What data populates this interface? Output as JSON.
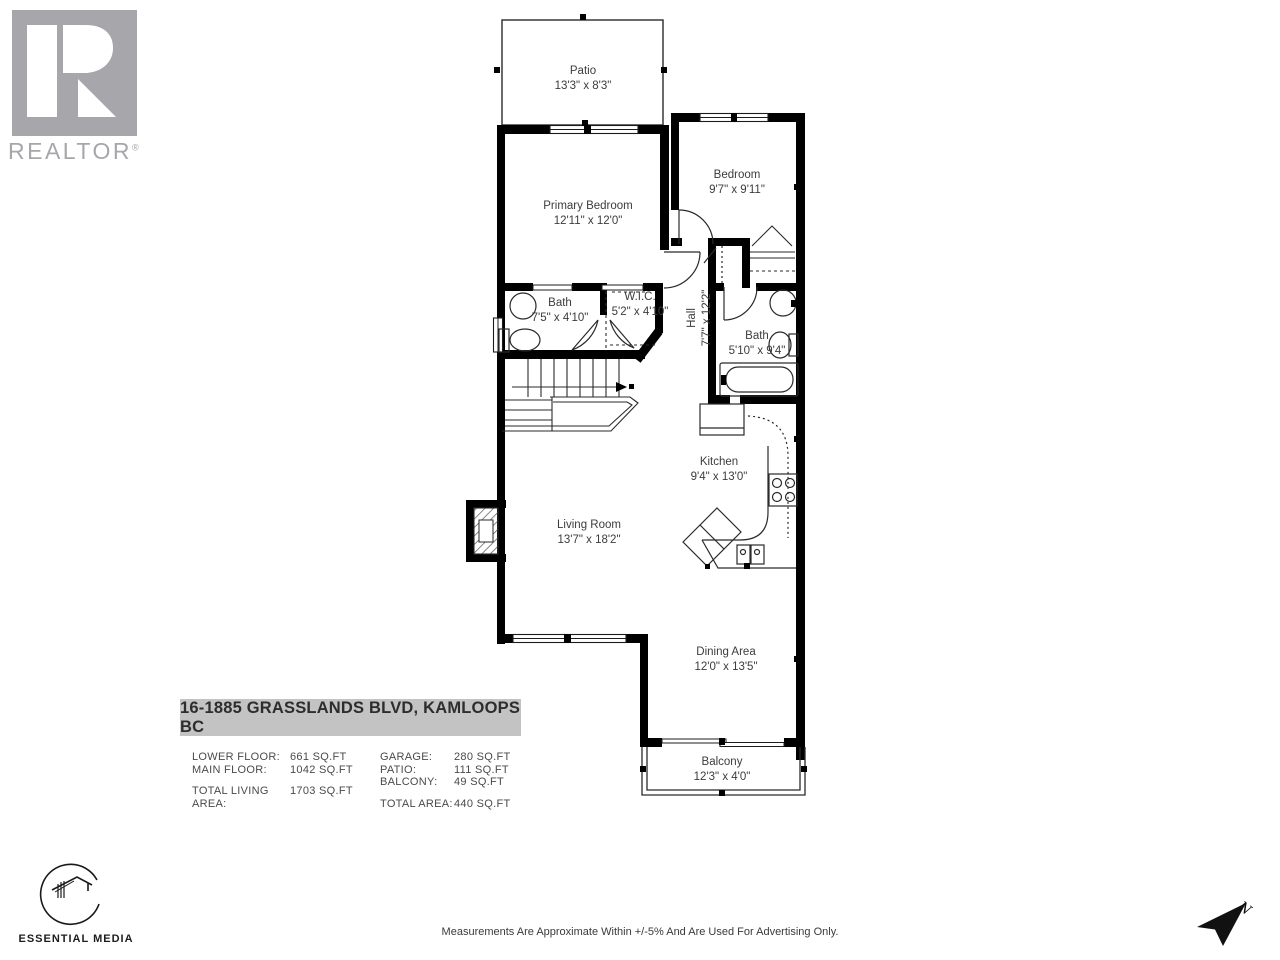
{
  "branding": {
    "realtor_logo_text": "REALTOR",
    "realtor_reg_mark": "®",
    "media_logo_text": "ESSENTIAL MEDIA"
  },
  "floorplan": {
    "rooms": [
      {
        "id": "patio",
        "name": "Patio",
        "dims": "13'3\" x 8'3\""
      },
      {
        "id": "primary-bedroom",
        "name": "Primary Bedroom",
        "dims": "12'11\" x 12'0\""
      },
      {
        "id": "bedroom",
        "name": "Bedroom",
        "dims": "9'7\" x 9'11\""
      },
      {
        "id": "bath-main",
        "name": "Bath",
        "dims": "7'5\" x 4'10\""
      },
      {
        "id": "wic",
        "name": "W.I.C.",
        "dims": "5'2\" x 4'10\""
      },
      {
        "id": "hall",
        "name": "Hall",
        "dims": "7'7\" x 12'2\""
      },
      {
        "id": "bath-second",
        "name": "Bath",
        "dims": "5'10\" x 9'4\""
      },
      {
        "id": "kitchen",
        "name": "Kitchen",
        "dims": "9'4\" x 13'0\""
      },
      {
        "id": "living-room",
        "name": "Living Room",
        "dims": "13'7\" x 18'2\""
      },
      {
        "id": "dining-area",
        "name": "Dining Area",
        "dims": "12'0\" x 13'5\""
      },
      {
        "id": "balcony",
        "name": "Balcony",
        "dims": "12'3\" x 4'0\""
      }
    ]
  },
  "address": {
    "label": "16-1885 GRASSLANDS BLVD, KAMLOOPS BC"
  },
  "areas": {
    "left_rows": [
      {
        "label": "LOWER FLOOR:",
        "value": "661 SQ.FT"
      },
      {
        "label": "MAIN FLOOR:",
        "value": "1042 SQ.FT"
      }
    ],
    "left_total": {
      "label": "TOTAL LIVING AREA:",
      "value": "1703 SQ.FT"
    },
    "right_rows": [
      {
        "label": "GARAGE:",
        "value": "280 SQ.FT"
      },
      {
        "label": "PATIO:",
        "value": "111 SQ.FT"
      },
      {
        "label": "BALCONY:",
        "value": "49 SQ.FT"
      }
    ],
    "right_total": {
      "label": "TOTAL AREA:",
      "value": "440 SQ.FT"
    }
  },
  "footer": {
    "disclaimer": "Measurements Are Approximate Within +/-5% And Are Used For Advertising Only."
  },
  "compass": {
    "north_label": "N"
  },
  "colors": {
    "wall": "#000000",
    "logo_gray": "#a7a7ab",
    "address_bg": "#c3c3c3"
  }
}
